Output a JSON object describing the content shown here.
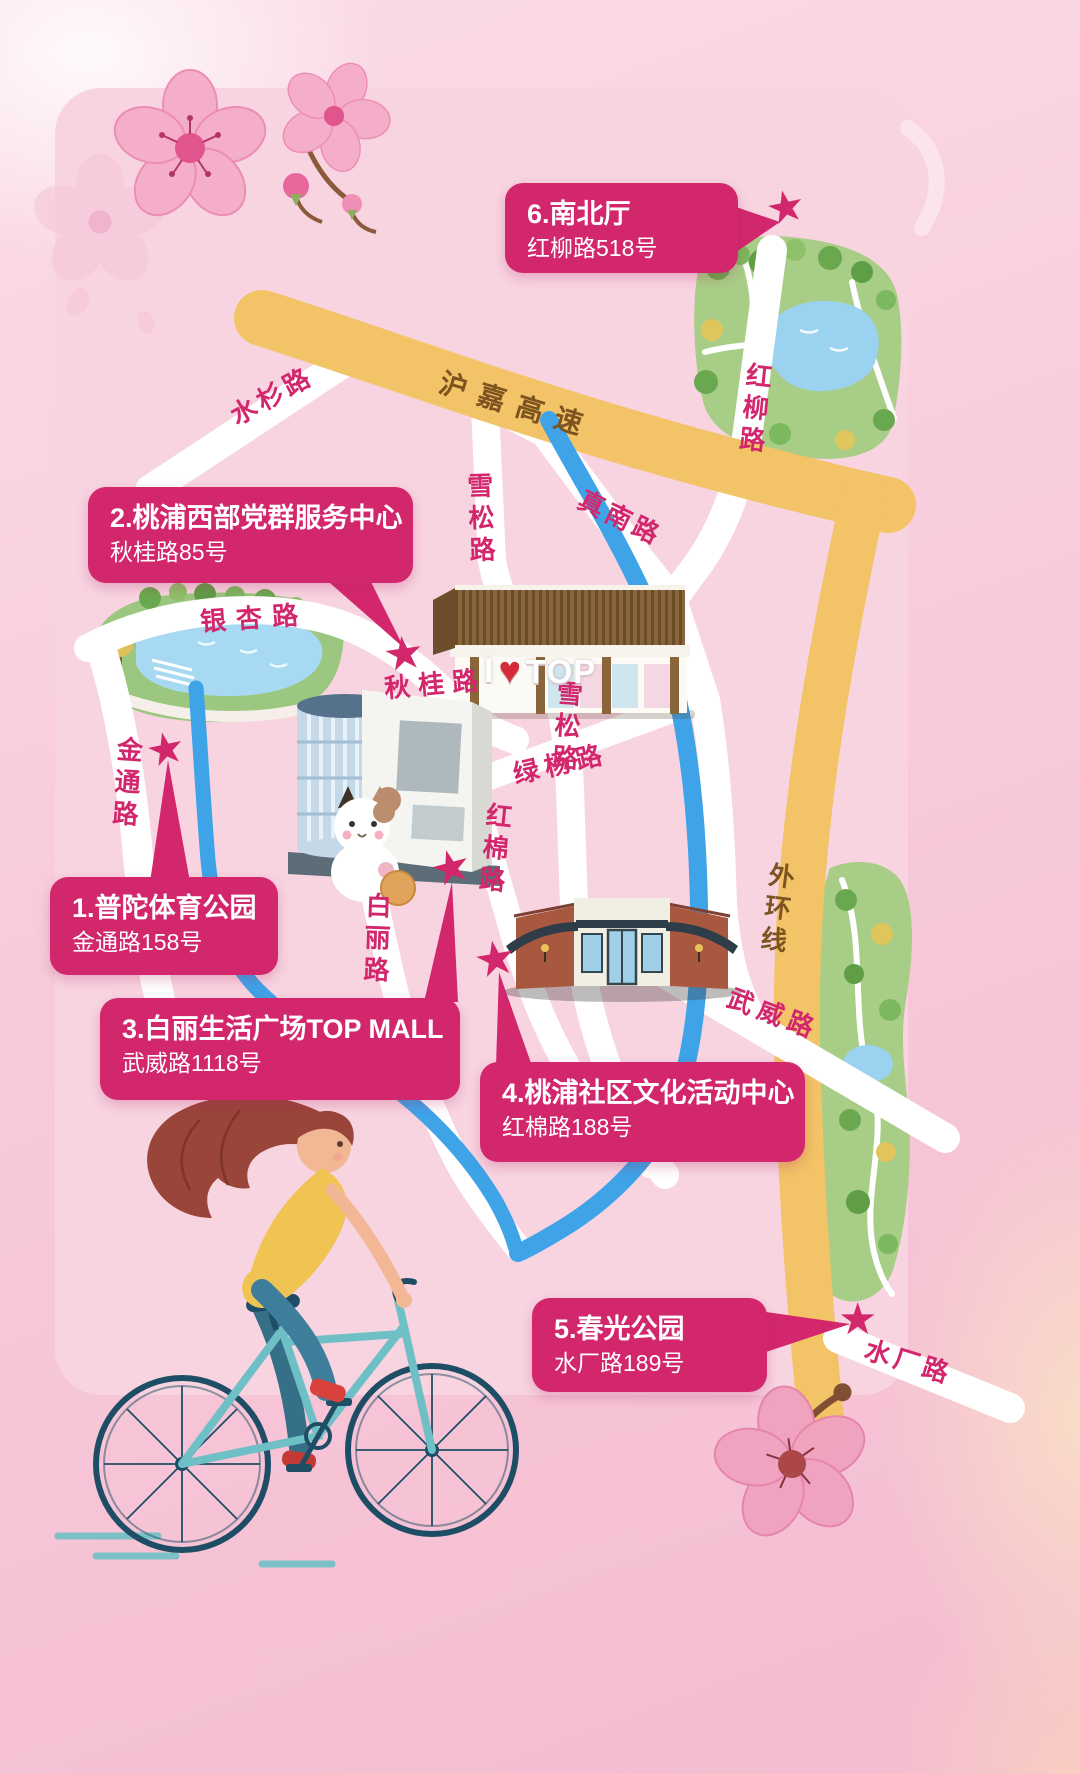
{
  "map": {
    "callouts": [
      {
        "title": "1.普陀体育公园",
        "address": "金通路158号"
      },
      {
        "title": "2.桃浦西部党群服务中心",
        "address": "秋桂路85号"
      },
      {
        "title": "3.白丽生活广场TOP MALL",
        "address": "武威路1118号"
      },
      {
        "title": "4.桃浦社区文化活动中心",
        "address": "红棉路188号"
      },
      {
        "title": "5.春光公园",
        "address": "水厂路189号"
      },
      {
        "title": "6.南北厅",
        "address": "红柳路518号"
      }
    ],
    "road_labels": [
      {
        "text": "水杉路"
      },
      {
        "text": "沪嘉高速"
      },
      {
        "text": "红柳路"
      },
      {
        "text": "真南路"
      },
      {
        "text": "雪松路"
      },
      {
        "text": "银杏路"
      },
      {
        "text": "秋桂路"
      },
      {
        "text": "金通路"
      },
      {
        "text": "绿杨路"
      },
      {
        "text": "雪松路"
      },
      {
        "text": "红棉路"
      },
      {
        "text": "白丽路"
      },
      {
        "text": "武威路"
      },
      {
        "text": "外环线"
      },
      {
        "text": "水厂路"
      }
    ],
    "top_sign": {
      "prefix": "I",
      "heart": "♥",
      "word": "TOP"
    },
    "marker_glyph": "★"
  },
  "colors": {
    "accent": "#d3276d",
    "highway_yellow": "#f3c368",
    "river_blue": "#3fa3e8",
    "park_green": "#a8cd86",
    "panel_pink": "#f8d4e1",
    "label_brown": "#7d5420"
  }
}
